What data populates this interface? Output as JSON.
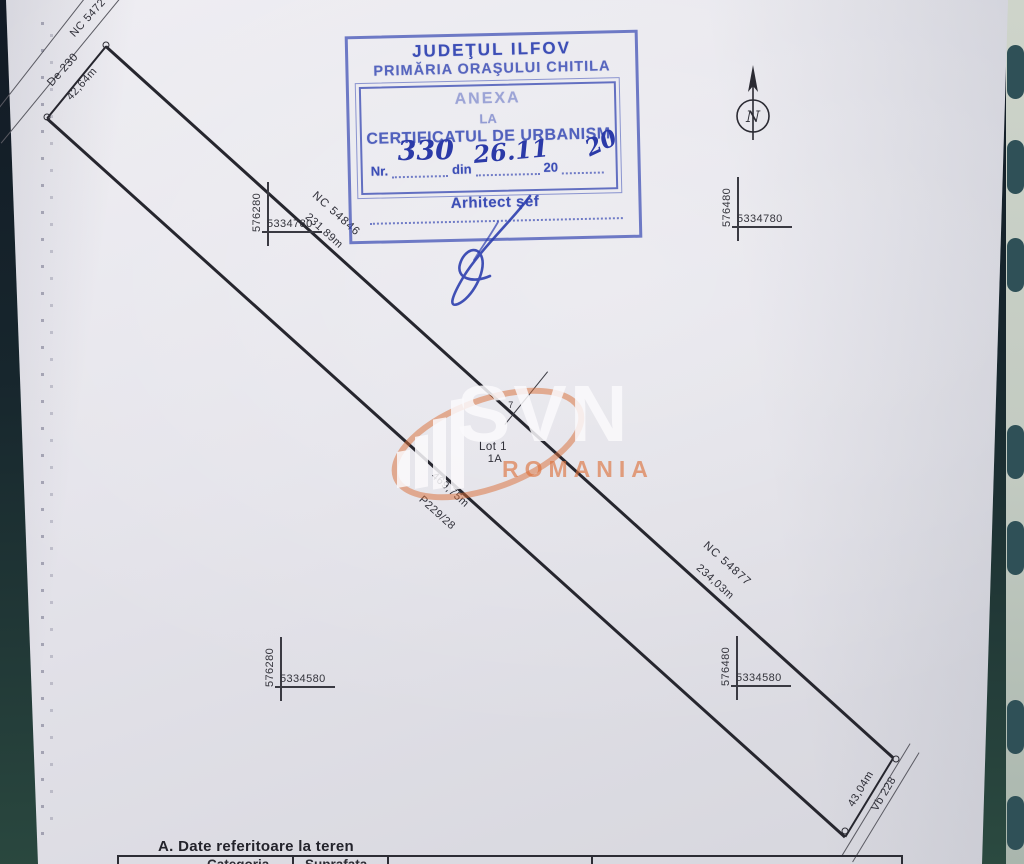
{
  "document": {
    "stamp": {
      "authority_line1": "JUDEŢUL ILFOV",
      "authority_line2": "PRIMĂRIA ORAŞULUI CHITILA",
      "annex": [
        "ANEXA",
        "LA",
        "CERTIFICATUL DE URBANISM"
      ],
      "nr_label": "Nr.",
      "nr_value": "330",
      "din_label": "din",
      "date_value": "26.11",
      "year_prefix": "20",
      "year_value": "20",
      "signer_title": "Arhitect şef"
    },
    "north": {
      "letter": "N"
    },
    "plan": {
      "road_label": "De 230",
      "top_width": "42,64m",
      "partial_nc": "NC 5472",
      "neighbor_top": {
        "nc": "NC 54846",
        "length": "231,89m"
      },
      "neighbor_bottom": {
        "nc": "NC 54877",
        "length": "234,03m"
      },
      "lot_name": "Lot 1",
      "lot_sub": "1A",
      "boundary_length": "469,75m",
      "parcel_id": "P229/28",
      "bottom_width": "43,04m",
      "ditch_label": "Vb 228",
      "point_label": "7",
      "crosses": [
        {
          "easting": "576280",
          "northing": "5334780"
        },
        {
          "easting": "576480",
          "northing": "5334780"
        },
        {
          "easting": "576280",
          "northing": "5334580"
        },
        {
          "easting": "576480",
          "northing": "5334580"
        }
      ]
    },
    "watermark": {
      "brand": "SVN",
      "country": "ROMANIA"
    },
    "footer": {
      "section_title": "A. Date referitoare la teren",
      "columns": [
        "Categoria",
        "Suprafata"
      ]
    },
    "colors": {
      "stamp_blue": "#3c4eb6",
      "ink_blue": "#2b3aa8",
      "plan_line": "#26262e",
      "accent_orange": "#d96c35",
      "paper": "#e4e3ea",
      "background_teal": "#2b4a40"
    }
  }
}
